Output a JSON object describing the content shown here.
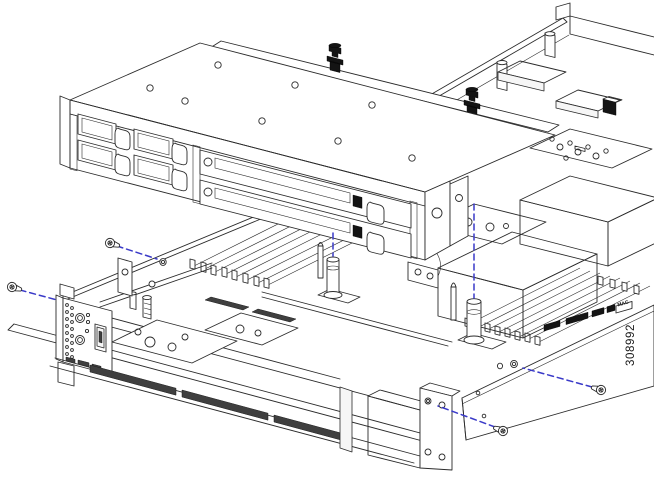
{
  "figure": {
    "number": "308992",
    "type": "exploded-isometric-line-illustration",
    "subject": "1U server chassis with front drive-bay module lifted out, screws and alignment guides shown"
  },
  "chassis": {
    "side_label": "MAC"
  },
  "annotations": {
    "screw_guide_count": 4,
    "alignment_guide_count": 2
  },
  "colors": {
    "background": "#ffffff",
    "line": "#2b2b2b",
    "guide_dashes": "#3a3ac8",
    "emi_gasket": "#3f3f3f",
    "thumbscrew": "#141414"
  }
}
